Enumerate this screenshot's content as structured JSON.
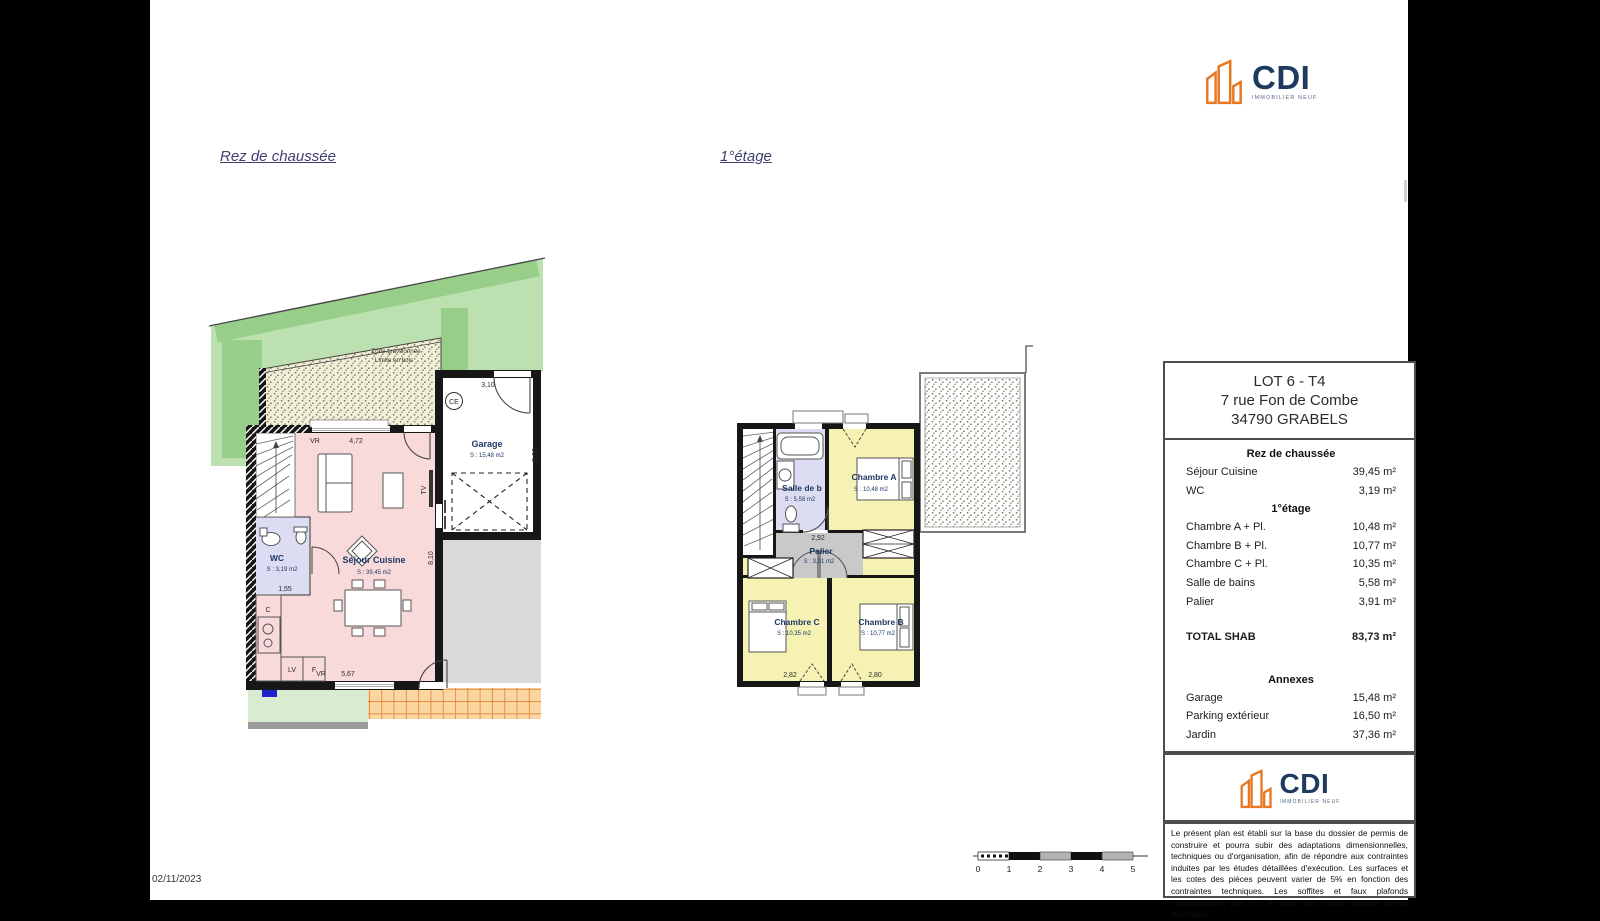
{
  "date": "02/11/2023",
  "titles": {
    "ground": "Rez de chaussée",
    "first": "1°étage"
  },
  "logo": {
    "name": "CDI",
    "tagline": "IMMOBILIER NEUF"
  },
  "colors": {
    "logo_orange": "#E87722",
    "logo_navy": "#1E3A5F",
    "room_pink": "#F8DADA",
    "room_yellow": "#F5F2B4",
    "room_lavender": "#DCDCF2",
    "palier_gray": "#C9C9C9",
    "garden_light": "#BCE0B0",
    "garden_dark": "#97CF8A",
    "gravel_beige": "#F2EFD9",
    "terrace_orange": "#DE8136",
    "parking_gray": "#D9D9D9",
    "marker_blue": "#2222CC"
  },
  "ground": {
    "zone_line1": "Zone gravillonnée",
    "zone_line2": "Limite en bois",
    "garage": {
      "name": "Garage",
      "area": "S : 15,48 m2"
    },
    "sejour": {
      "name": "Séjour Cuisine",
      "area": "S : 39,45 m2"
    },
    "wc": {
      "name": "WC",
      "area": "S : 3,19 m2"
    },
    "ce": "CE",
    "tv": "TV",
    "lv": "LV",
    "f": "F",
    "c": "C",
    "dims": {
      "vr": "VR",
      "d472": "4,72",
      "d567": "5,67",
      "d310": "3,10",
      "d500": "5,00",
      "d810": "8,10",
      "d155": "1,55"
    }
  },
  "first": {
    "sdb": {
      "name": "Salle de b",
      "area": "S : 5,58 m2"
    },
    "cha": {
      "name": "Chambre A",
      "area": "S : 10,48 m2"
    },
    "chb": {
      "name": "Chambre B",
      "area": "S : 10,77 m2"
    },
    "chc": {
      "name": "Chambre C",
      "area": "S : 10,35 m2"
    },
    "palier": {
      "name": "Palier",
      "area": "S : 3,91 m2"
    },
    "dims": {
      "d292": "2,92",
      "d282": "2,82",
      "d280": "2,80"
    }
  },
  "panel": {
    "lot": "LOT 6 - T4",
    "address1": "7 rue Fon de Combe",
    "address2": "34790 GRABELS",
    "rdc_header": "Rez de chaussée",
    "rdc_rows": [
      {
        "label": "Séjour Cuisine",
        "value": "39,45 m²"
      },
      {
        "label": "WC",
        "value": "3,19 m²"
      }
    ],
    "etage_header": "1°étage",
    "etage_rows": [
      {
        "label": "Chambre A + Pl.",
        "value": "10,48 m²"
      },
      {
        "label": "Chambre B + Pl.",
        "value": "10,77 m²"
      },
      {
        "label": "Chambre C + Pl.",
        "value": "10,35 m²"
      },
      {
        "label": "Salle de bains",
        "value": "5,58 m²"
      },
      {
        "label": "Palier",
        "value": "3,91 m²"
      }
    ],
    "total_label": "TOTAL SHAB",
    "total_value": "83,73 m²",
    "annexes_header": "Annexes",
    "annex_rows": [
      {
        "label": "Garage",
        "value": "15,48 m²"
      },
      {
        "label": "Parking extérieur",
        "value": "16,50 m²"
      },
      {
        "label": "Jardin",
        "value": "37,36 m²"
      }
    ],
    "disclaimer": "Le présent plan est établi sur la base du dossier de permis de construire et pourra subir des adaptations dimensionnelles, techniques ou d'organisation, afin de répondre aux contraintes induites par les études détaillées d'exécution. Les surfaces et les cotes des pièces peuvent varier de 5% en fonction des contraintes techniques. Les soffites et faux plafonds n'apparaissent pas sur le plan. Les volets roulants seront monobloc."
  },
  "scalebar": {
    "ticks": [
      "0",
      "1",
      "2",
      "3",
      "4",
      "5"
    ]
  }
}
